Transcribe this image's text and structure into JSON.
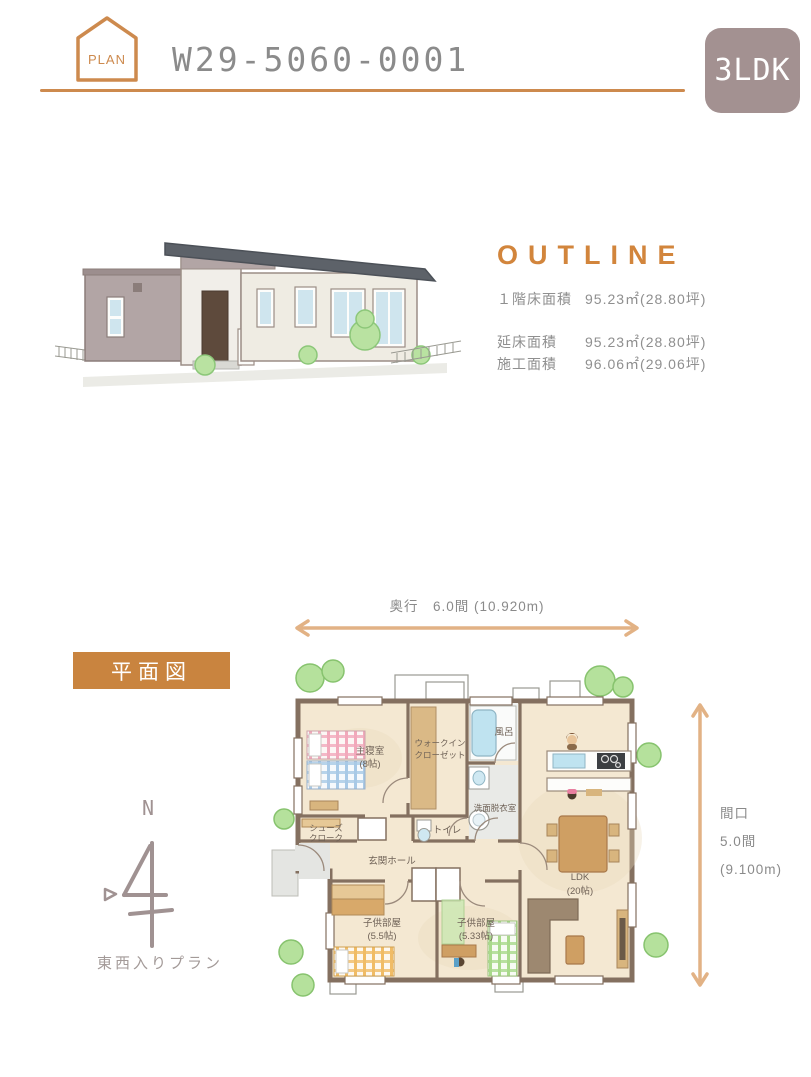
{
  "header": {
    "plan_badge": "PLAN",
    "plan_number": "W29-5060-0001",
    "layout_badge": "3LDK"
  },
  "outline": {
    "title": "OUTLINE",
    "rows": [
      {
        "label": "１階床面積",
        "value": "95.23㎡(28.80坪)"
      },
      {
        "label": "延床面積",
        "value": "95.23㎡(28.80坪)"
      },
      {
        "label": "施工面積",
        "value": "96.06㎡(29.06坪)"
      }
    ]
  },
  "floor_plan": {
    "section_label": "平面図",
    "depth_dimension": "奥行　6.0間 (10.920m)",
    "width_dimension": [
      "間口",
      "5.0間",
      "(9.100m)"
    ],
    "compass": {
      "north": "N",
      "plan_type": "東西入りプラン"
    },
    "rooms": {
      "master_bedroom": {
        "name": "主寝室",
        "size": "(8帖)"
      },
      "walk_in_closet": {
        "line1": "ウォークイン",
        "line2": "クローゼット"
      },
      "bath": {
        "name": "風呂"
      },
      "washroom": {
        "name": "洗面脱衣室"
      },
      "toilet": {
        "name": "トイレ"
      },
      "shoes_cloak": {
        "line1": "シューズ",
        "line2": "クローク"
      },
      "entrance_hall": {
        "name": "玄関ホール"
      },
      "kids_room_1": {
        "name": "子供部屋",
        "size": "(5.5帖)"
      },
      "kids_room_2": {
        "name": "子供部屋",
        "size": "(5.33帖)"
      },
      "ldk": {
        "name": "LDK",
        "size": "(20帖)"
      }
    }
  },
  "colors": {
    "accent_orange": "#cd8a4e",
    "section_orange": "#c9843f",
    "outline_orange": "#d2853c",
    "badge_mauve": "#a39191",
    "text_gray": "#8b8b8b",
    "compass_mauve": "#a09292",
    "floor_cream": "#f4e8d2",
    "wall_brown": "#847060",
    "tree_green": "#b5e19c",
    "water_blue": "#bfe3f0"
  }
}
